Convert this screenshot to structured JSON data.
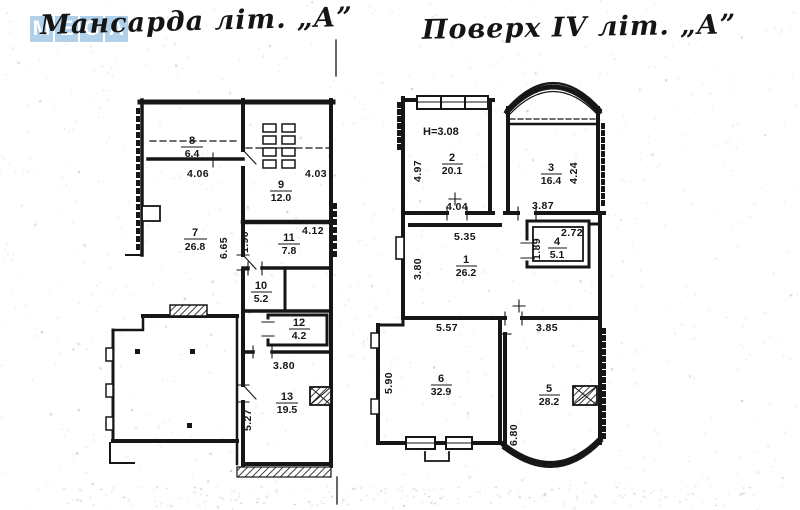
{
  "watermark": {
    "letters": [
      "M",
      "E",
      "G",
      "A"
    ]
  },
  "titles": {
    "left": "Мансарда  літ. „А”",
    "right": "Поверх  ІV  літ. „А”"
  },
  "plans": {
    "left": {
      "name": "Мансарда",
      "rooms": {
        "r7": {
          "number": "7",
          "area": "26.8"
        },
        "r8": {
          "number": "8",
          "area": "6.4"
        },
        "r9": {
          "number": "9",
          "area": "12.0"
        },
        "r10": {
          "number": "10",
          "area": "5.2"
        },
        "r11": {
          "number": "11",
          "area": "7.8"
        },
        "r12": {
          "number": "12",
          "area": "4.2"
        },
        "r13": {
          "number": "13",
          "area": "19.5"
        }
      },
      "dims": {
        "room8_w": "4.06",
        "room9_w": "4.03",
        "room7_h": "6.65",
        "room11_side": "1.90",
        "room11_w": "4.12",
        "room13_w": "3.80",
        "room13_h": "5.27"
      }
    },
    "right": {
      "name": "Поверх IV",
      "height_note": "Н=3.08",
      "rooms": {
        "r1": {
          "number": "1",
          "area": "26.2"
        },
        "r2": {
          "number": "2",
          "area": "20.1"
        },
        "r3": {
          "number": "3",
          "area": "16.4"
        },
        "r4": {
          "number": "4",
          "area": "5.1"
        },
        "r5": {
          "number": "5",
          "area": "28.2"
        },
        "r6": {
          "number": "6",
          "area": "32.9"
        }
      },
      "dims": {
        "room2_h": "4.97",
        "room2_w": "4.04",
        "room3_h": "4.24",
        "room3_w": "3.87",
        "room1_w": "5.35",
        "room1_h": "3.80",
        "room4_w": "2.72",
        "room4_h": "1.89",
        "room6_w": "5.57",
        "room6_h": "5.90",
        "room5_w": "3.85",
        "room5_h": "6.80"
      }
    }
  }
}
